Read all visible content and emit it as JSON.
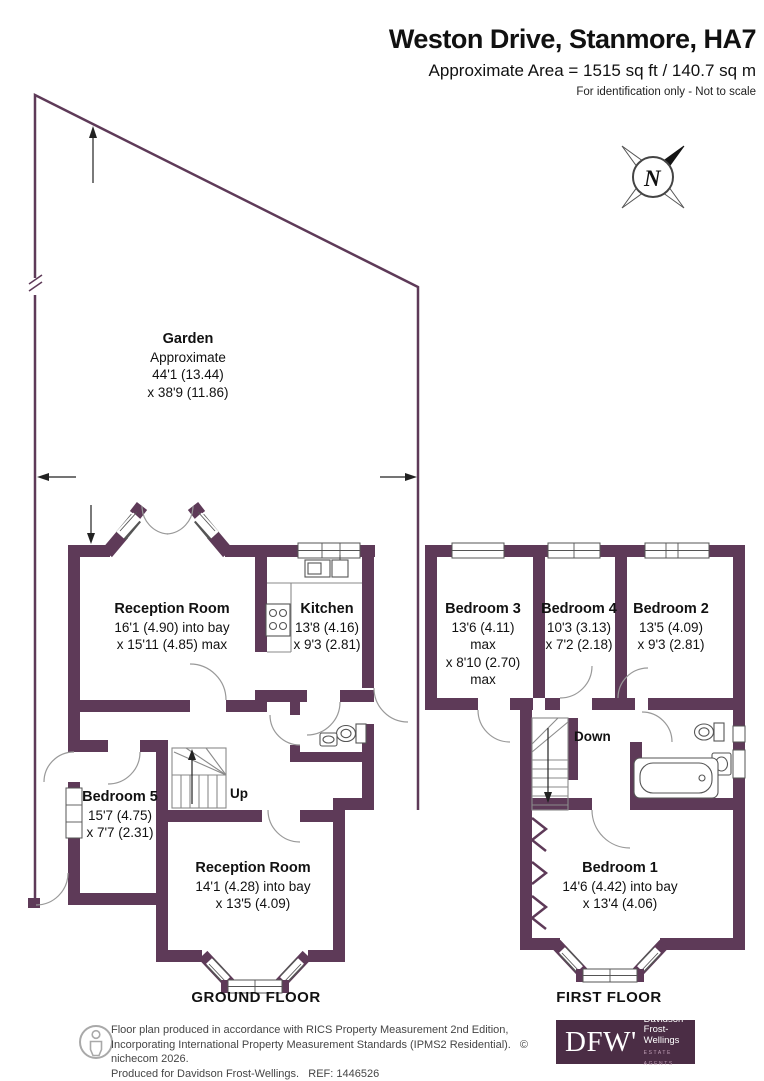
{
  "header": {
    "title": "Weston Drive, Stanmore, HA7",
    "subtitle": "Approximate Area = 1515 sq ft / 140.7 sq m",
    "note": "For identification only - Not to scale"
  },
  "compass": {
    "label": "N"
  },
  "garden": {
    "name": "Garden",
    "l1": "Approximate",
    "l2": "44'1 (13.44)",
    "l3": "x 38'9 (11.86)"
  },
  "ground": {
    "floor_label": "GROUND FLOOR",
    "stairs_label": "Up",
    "reception_top": {
      "name": "Reception Room",
      "l1": "16'1 (4.90) into bay",
      "l2": "x 15'11 (4.85) max"
    },
    "kitchen": {
      "name": "Kitchen",
      "l1": "13'8 (4.16)",
      "l2": "x 9'3 (2.81)"
    },
    "bedroom5": {
      "name": "Bedroom 5",
      "l1": "15'7 (4.75)",
      "l2": "x 7'7 (2.31)"
    },
    "reception_bottom": {
      "name": "Reception Room",
      "l1": "14'1 (4.28) into bay",
      "l2": "x 13'5 (4.09)"
    }
  },
  "first": {
    "floor_label": "FIRST FLOOR",
    "stairs_label": "Down",
    "bedroom3": {
      "name": "Bedroom 3",
      "l1": "13'6 (4.11)",
      "l2": "max",
      "l3": "x 8'10 (2.70)",
      "l4": "max"
    },
    "bedroom4": {
      "name": "Bedroom 4",
      "l1": "10'3 (3.13)",
      "l2": "x 7'2 (2.18)"
    },
    "bedroom2": {
      "name": "Bedroom 2",
      "l1": "13'5 (4.09)",
      "l2": "x 9'3 (2.81)"
    },
    "bedroom1": {
      "name": "Bedroom 1",
      "l1": "14'6 (4.42) into bay",
      "l2": "x 13'4 (4.06)"
    }
  },
  "footer": {
    "line1": "Floor plan produced in accordance with RICS Property Measurement 2nd Edition,",
    "line2": "Incorporating International Property Measurement Standards (IPMS2 Residential).",
    "copyright": "© nichecom 2026.",
    "line3": "Produced for Davidson Frost-Wellings.   REF: 1446526",
    "logo": {
      "initials": "DFW'",
      "name1": "Davidson",
      "name2": "Frost-Wellings",
      "tagline": "ESTATE AGENTS"
    }
  },
  "colors": {
    "wall": "#5e3a58",
    "logo_bg": "#4b2d45"
  }
}
